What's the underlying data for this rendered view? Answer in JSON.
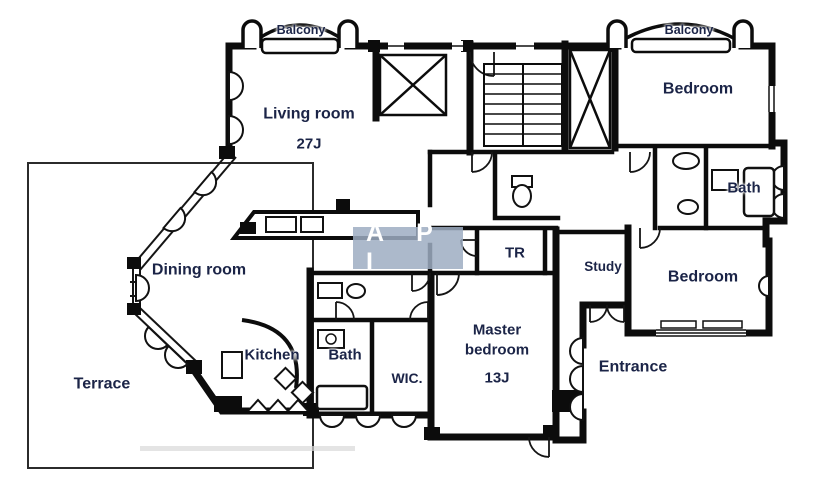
{
  "plan": {
    "balcony_left": "Balcony",
    "balcony_right": "Balcony",
    "living_room": "Living room",
    "living_room_size": "27J",
    "bedroom_top": "Bedroom",
    "bath_right": "Bath",
    "bedroom_right": "Bedroom",
    "study": "Study",
    "tr": "TR",
    "dining_room": "Dining room",
    "terrace": "Terrace",
    "kitchen": "Kitchen",
    "bath_left": "Bath",
    "wic": "WIC.",
    "master_bedroom": "Master bedroom",
    "master_bedroom_size": "13J",
    "entrance": "Entrance"
  },
  "watermark": {
    "text": "A P I"
  },
  "colors": {
    "wall": "#0c0c0c",
    "label": "#1b2447",
    "watermark_bg": "#9eadc2",
    "watermark_fg": "#ffffff"
  }
}
